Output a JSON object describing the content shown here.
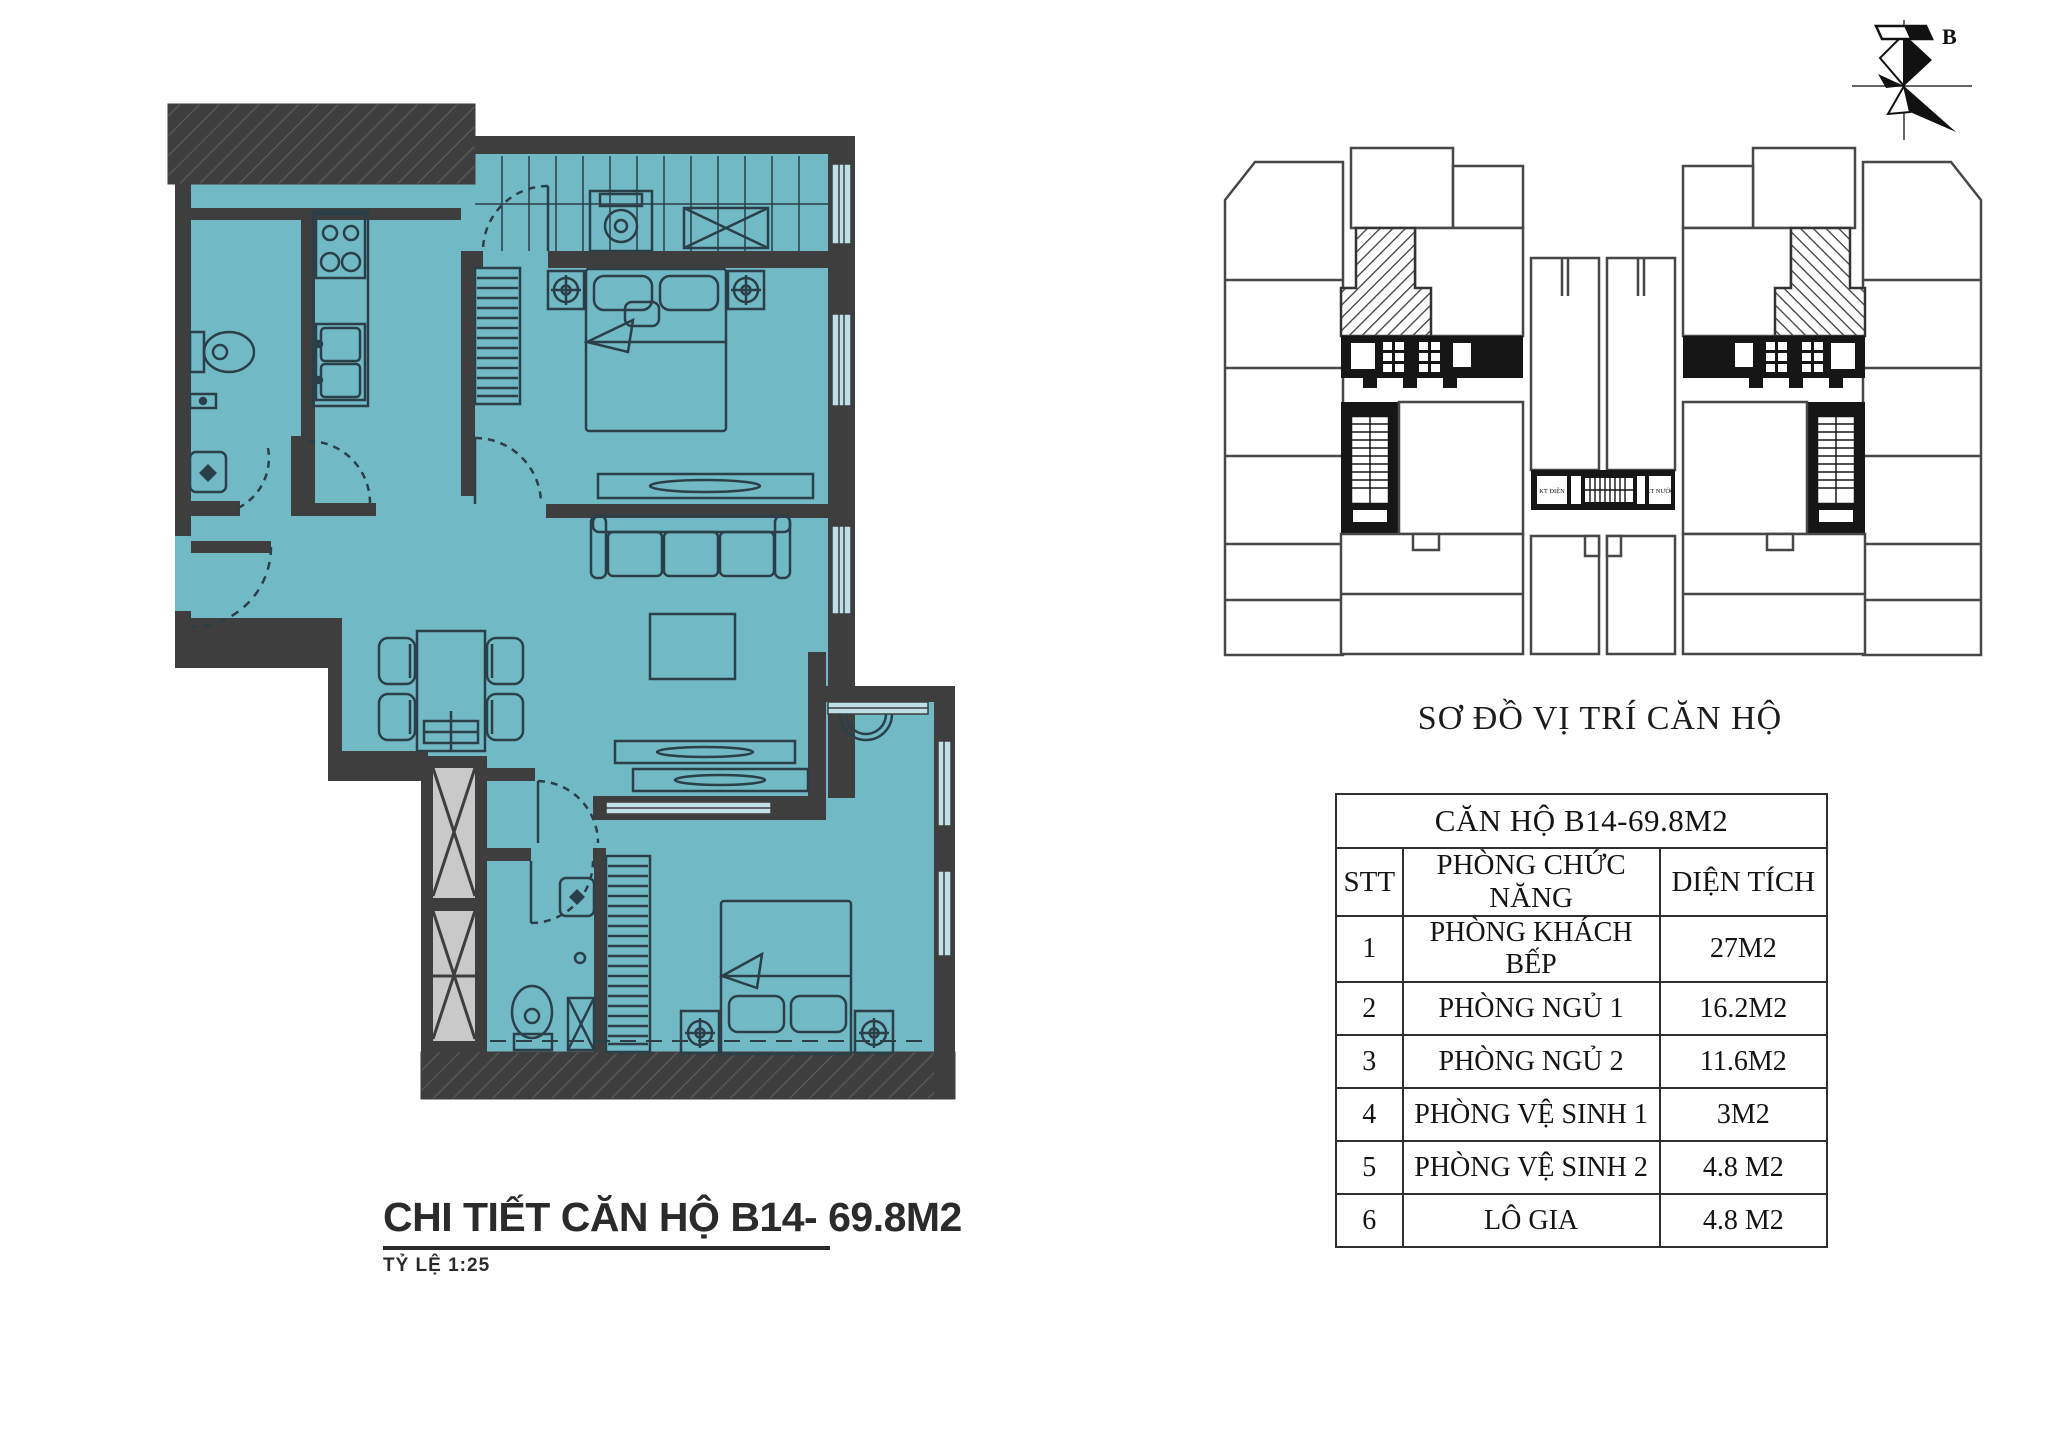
{
  "floor_plan": {
    "title": "CHI TIẾT CĂN HỘ B14- 69.8M2",
    "scale_label": "TỶ LỆ  1:25",
    "colors": {
      "floor": "#72b9c6",
      "wall": "#3e3e3e",
      "furniture_line": "#2b3f48",
      "window_glass": "#bfe0e6",
      "shaft_fill": "#c9c9c9"
    }
  },
  "site_plan": {
    "caption": "SƠ ĐỒ VỊ TRÍ CĂN HỘ",
    "north_label": "B",
    "shaft_label_left": "KT ĐIỆN",
    "shaft_label_right": "KT NƯỚC",
    "highlight_style": "diagonal-hatch"
  },
  "area_table": {
    "title": "CĂN HỘ B14-69.8M2",
    "columns": [
      "STT",
      "PHÒNG CHỨC NĂNG",
      "DIỆN TÍCH"
    ],
    "rows": [
      {
        "stt": "1",
        "room": "PHÒNG KHÁCH BẾP",
        "area": "27M2"
      },
      {
        "stt": "2",
        "room": "PHÒNG NGỦ 1",
        "area": "16.2M2"
      },
      {
        "stt": "3",
        "room": "PHÒNG NGỦ 2",
        "area": "11.6M2"
      },
      {
        "stt": "4",
        "room": "PHÒNG VỆ SINH 1",
        "area": "3M2"
      },
      {
        "stt": "5",
        "room": "PHÒNG VỆ SINH 2",
        "area": "4.8 M2"
      },
      {
        "stt": "6",
        "room": "LÔ GIA",
        "area": "4.8 M2"
      }
    ]
  }
}
